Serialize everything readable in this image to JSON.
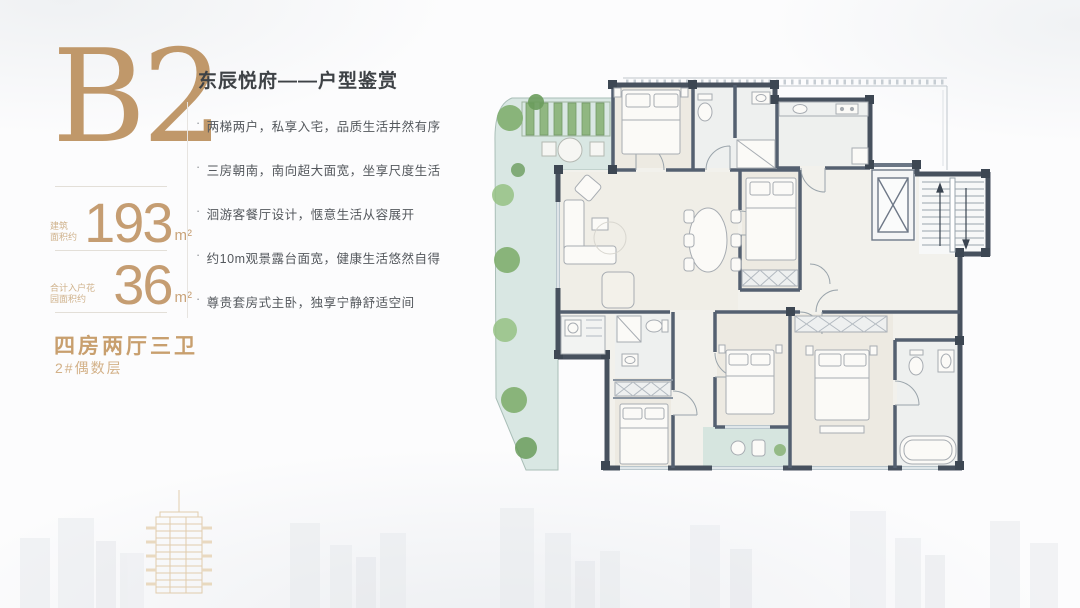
{
  "panel": {
    "unit_code": "B2",
    "areas": [
      {
        "label_lines": [
          "建筑",
          "面积约"
        ],
        "value": "193",
        "unit": "m²"
      },
      {
        "label_lines": [
          "合计入户花",
          "园面积约"
        ],
        "value": "36",
        "unit": "m²"
      }
    ],
    "layout_type": "四房两厅三卫",
    "floor_note": "2#偶数层"
  },
  "content": {
    "title": "东辰悦府——户型鉴赏",
    "bullet_marker": "·",
    "bullets": [
      "两梯两户，私享入宅，品质生活井然有序",
      "三房朝南，南向超大面宽，坐享尺度生活",
      "洄游客餐厅设计，惬意生活从容展开",
      "约10m观景露台面宽，健康生活悠然自得",
      "尊贵套房式主卧，独享宁静舒适空间"
    ]
  },
  "colors": {
    "gold": "#c0986a",
    "gold_light": "#d3b188",
    "title_text": "#3e4246",
    "body_text": "#54585d",
    "wall": "#47515e",
    "terrace_floor": "#d9e7e3",
    "plant_green": "#86b175",
    "room_floor": "#edeae2"
  }
}
